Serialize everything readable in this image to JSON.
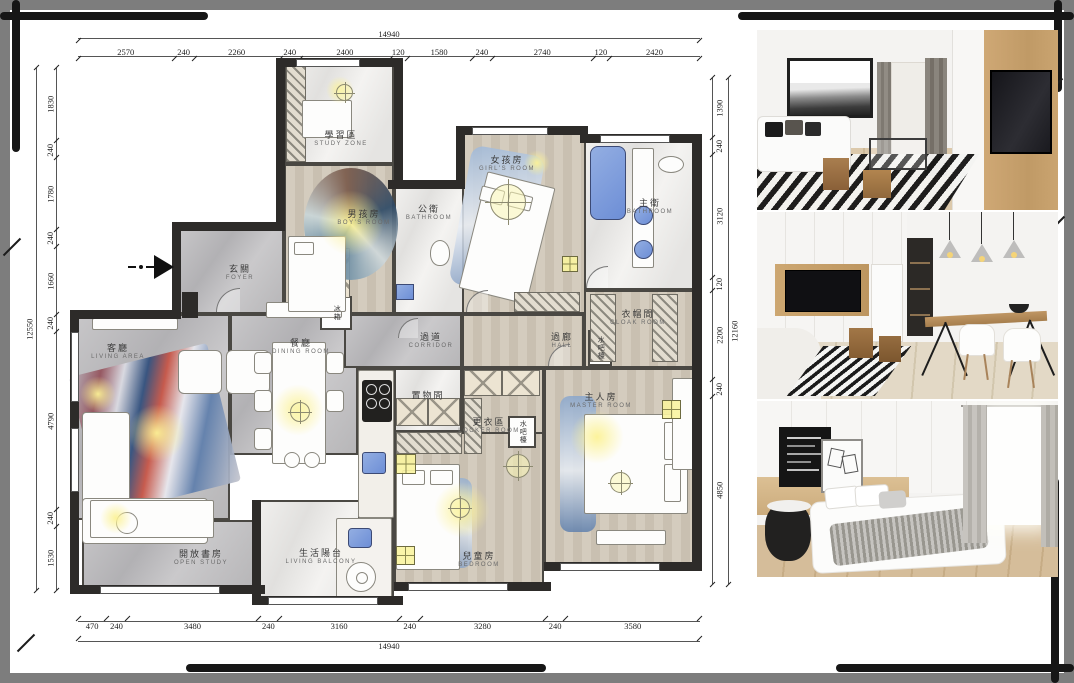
{
  "document": {
    "type": "apartment floor plan presentation board"
  },
  "dimensions": {
    "top": {
      "total": 14940,
      "segments": [
        2570,
        240,
        2260,
        240,
        2400,
        120,
        1580,
        240,
        2740,
        120,
        2420
      ]
    },
    "bottom": {
      "total": 14940,
      "segments": [
        470,
        240,
        3480,
        240,
        3160,
        240,
        3280,
        240,
        3580
      ]
    },
    "left": {
      "total": 12550,
      "segments": [
        1830,
        240,
        1780,
        240,
        1660,
        240,
        4790,
        240,
        1530
      ]
    },
    "right": {
      "total": 12160,
      "segments": [
        1390,
        240,
        3120,
        120,
        2200,
        240,
        4850
      ]
    }
  },
  "floor_plan": {
    "rooms": [
      {
        "id": "study-zone",
        "zh": "學習區",
        "en": "STUDY ZONE",
        "x": 284,
        "y": 64,
        "w": 110,
        "h": 100,
        "lx": 341,
        "ly": 139,
        "floor": "marble"
      },
      {
        "id": "boy-room",
        "zh": "男孩房",
        "en": "BOY'S ROOM",
        "x": 284,
        "y": 164,
        "w": 110,
        "h": 150,
        "lx": 364,
        "ly": 218,
        "floor": "wood"
      },
      {
        "id": "public-bath",
        "zh": "公衛",
        "en": "BATHROOM",
        "x": 394,
        "y": 184,
        "w": 70,
        "h": 130,
        "lx": 429,
        "ly": 213,
        "floor": "marble"
      },
      {
        "id": "girl-room",
        "zh": "女孩房",
        "en": "GIRL'S ROOM",
        "x": 462,
        "y": 132,
        "w": 124,
        "h": 182,
        "lx": 507,
        "ly": 164,
        "floor": "wood"
      },
      {
        "id": "master-bath",
        "zh": "主衛",
        "en": "BATHROOM",
        "x": 584,
        "y": 138,
        "w": 112,
        "h": 152,
        "lx": 650,
        "ly": 207,
        "floor": "marble"
      },
      {
        "id": "foyer",
        "zh": "玄關",
        "en": "FOYER",
        "x": 178,
        "y": 226,
        "w": 106,
        "h": 88,
        "lx": 240,
        "ly": 273,
        "floor": "gray"
      },
      {
        "id": "living",
        "zh": "客廳",
        "en": "LIVING AREA",
        "x": 76,
        "y": 314,
        "w": 154,
        "h": 206,
        "lx": 118,
        "ly": 352,
        "floor": "gray"
      },
      {
        "id": "dining",
        "zh": "餐廳",
        "en": "DINING ROOM",
        "x": 230,
        "y": 314,
        "w": 128,
        "h": 141,
        "lx": 301,
        "ly": 347,
        "floor": "gray"
      },
      {
        "id": "corridor",
        "zh": "過道",
        "en": "CORRIDOR",
        "x": 344,
        "y": 314,
        "w": 118,
        "h": 54,
        "lx": 431,
        "ly": 341,
        "floor": "gray"
      },
      {
        "id": "hall",
        "zh": "過廊",
        "en": "HALL",
        "x": 462,
        "y": 314,
        "w": 122,
        "h": 54,
        "lx": 562,
        "ly": 341,
        "floor": "wood"
      },
      {
        "id": "cloak-room",
        "zh": "衣帽間",
        "en": "CLOAK ROOM",
        "x": 584,
        "y": 290,
        "w": 112,
        "h": 78,
        "lx": 638,
        "ly": 318,
        "floor": "wood"
      },
      {
        "id": "storage",
        "zh": "置物間",
        "en": "",
        "x": 394,
        "y": 368,
        "w": 68,
        "h": 64,
        "lx": 428,
        "ly": 396,
        "floor": "marble"
      },
      {
        "id": "locker-room",
        "zh": "更衣區",
        "en": "LOCKER ROOM",
        "x": 462,
        "y": 368,
        "w": 82,
        "h": 100,
        "lx": 489,
        "ly": 426,
        "floor": "wood"
      },
      {
        "id": "master-room",
        "zh": "主人房",
        "en": "MASTER ROOM",
        "x": 544,
        "y": 368,
        "w": 152,
        "h": 198,
        "lx": 601,
        "ly": 401,
        "floor": "wood"
      },
      {
        "id": "kid-room",
        "zh": "兒童房",
        "en": "BEDROOM",
        "x": 394,
        "y": 432,
        "w": 150,
        "h": 152,
        "lx": 479,
        "ly": 560,
        "floor": "wood"
      },
      {
        "id": "open-study",
        "zh": "開放書房",
        "en": "OPEN STUDY",
        "x": 82,
        "y": 520,
        "w": 174,
        "h": 68,
        "lx": 201,
        "ly": 558,
        "floor": "gray"
      },
      {
        "id": "balcony",
        "zh": "生活陽台",
        "en": "LIVING BALCONY",
        "x": 256,
        "y": 500,
        "w": 138,
        "h": 102,
        "lx": 321,
        "ly": 557,
        "floor": "marble"
      },
      {
        "id": "kitchen",
        "zh": "",
        "en": "",
        "x": 358,
        "y": 368,
        "w": 36,
        "h": 152,
        "lx": 0,
        "ly": 0,
        "floor": "marble"
      },
      {
        "id": "water-bar-1",
        "zh": "水吧檯",
        "en": "",
        "x": 588,
        "y": 330,
        "w": 24,
        "h": 36,
        "lx": 600,
        "ly": 348,
        "floor": "white",
        "vert": true
      },
      {
        "id": "water-bar-2",
        "zh": "水吧檯",
        "en": "",
        "x": 508,
        "y": 416,
        "w": 28,
        "h": 32,
        "lx": 522,
        "ly": 432,
        "floor": "white",
        "vert": true
      },
      {
        "id": "fridge",
        "zh": "冰箱",
        "en": "",
        "x": 320,
        "y": 296,
        "w": 32,
        "h": 34,
        "lx": 336,
        "ly": 313,
        "floor": "white",
        "vert": true
      }
    ]
  },
  "photos": [
    {
      "id": "living-room-photo"
    },
    {
      "id": "dining-area-photo"
    },
    {
      "id": "bedroom-photo"
    }
  ]
}
